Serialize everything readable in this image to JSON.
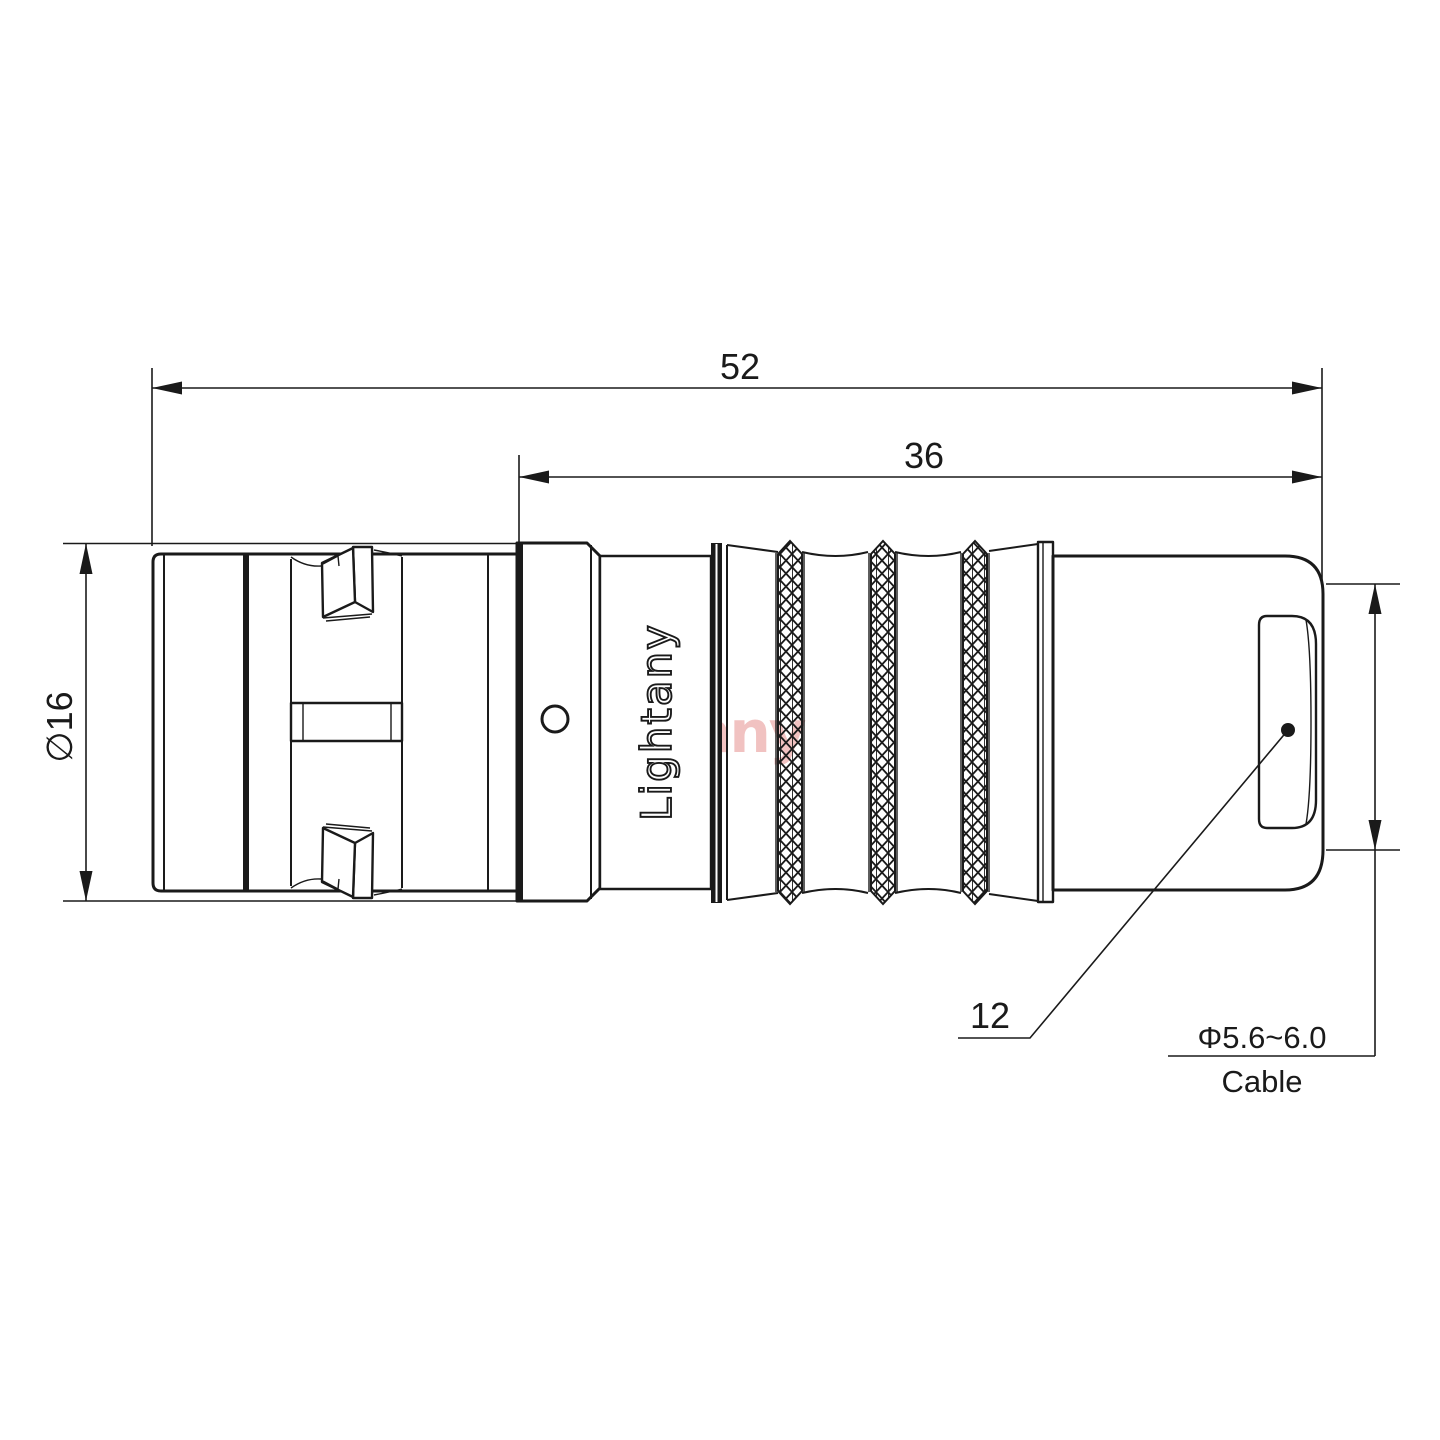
{
  "page": {
    "background": "#ffffff",
    "description": "Technical dimension drawing of a Lightany push-pull circular cable connector, side view"
  },
  "drawing": {
    "dimensions": {
      "overall_length": "52",
      "rear_section_length": "36",
      "shell_diameter": "∅16",
      "boot_diameter": "12",
      "cable_range": "Φ5.6~6.0",
      "cable_word": "Cable"
    },
    "branding": {
      "engraving": "Lightany",
      "watermark": "Lightany"
    },
    "colors": {
      "line": "#1a1a1a",
      "watermark": "#d9534f",
      "background": "#ffffff"
    }
  }
}
